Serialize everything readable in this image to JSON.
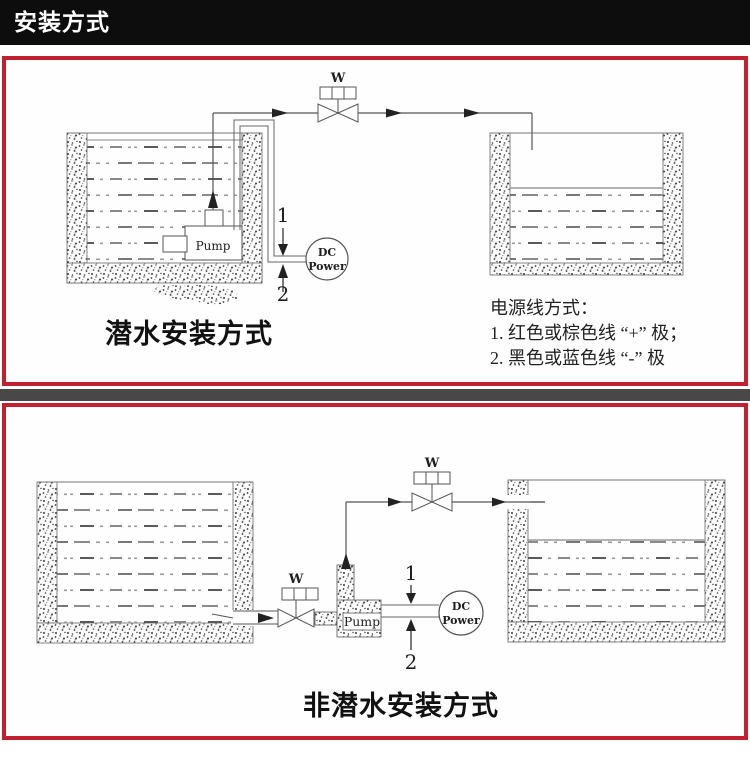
{
  "header": {
    "title": "安装方式"
  },
  "colors": {
    "accent_red": "#c2202e",
    "header_bg": "#0d0d0d",
    "divider_gray": "#4a4747",
    "line_gray": "#555555"
  },
  "panels": {
    "top": {
      "caption": "潜水安装方式",
      "note": {
        "title": "电源线方式：",
        "line1": "1. 红色或棕色线 “+” 极；",
        "line2": "2. 黑色或蓝色线 “-” 极"
      },
      "labels": {
        "valve": "W",
        "pump": "Pump",
        "power_line1": "DC",
        "power_line2": "Power",
        "wire_positive": "1",
        "wire_negative": "2"
      }
    },
    "bottom": {
      "caption": "非潜水安装方式",
      "labels": {
        "inlet_valve": "W",
        "outlet_valve": "W",
        "pump": "Pump",
        "power_line1": "DC",
        "power_line2": "Power",
        "wire_positive": "1",
        "wire_negative": "2"
      }
    }
  }
}
